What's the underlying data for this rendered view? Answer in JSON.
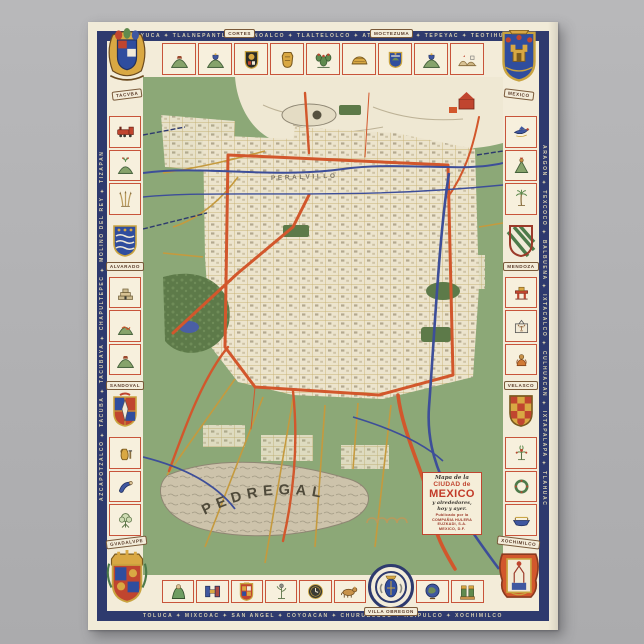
{
  "poster": {
    "kind": "vintage pictorial map poster of Mexico City on gray backdrop"
  },
  "colors": {
    "backdrop_gray": "#b3b3b5",
    "paper_cream": "#f1ebd8",
    "frame_blue": "#2e3a6e",
    "cell_border_red": "#c8543a",
    "map_green": "#8ca877",
    "water_blue": "#3d4e99",
    "road_orange": "#d2572c",
    "road_gold": "#c59a3e",
    "park_green": "#5d7a49",
    "pedregal_gray": "#cdc3ab",
    "accent_red": "#c0452f"
  },
  "banners": {
    "top_left_corner": "TACVBA",
    "top_right_corner": "MEXICO",
    "top_banner_1": "CORTES",
    "top_banner_2": "MOCTEZUMA",
    "left_shield_upper": "ALVARADO",
    "left_shield_lower": "SANDOVAL",
    "right_shield_upper": "MENDOZA",
    "right_shield_lower": "VELASCO",
    "bottom_left_corner": "GVADALVPE",
    "bottom_right_corner": "XOCHIMILCO",
    "bottom_medallion": "VILLA OBREGON"
  },
  "frame_text": {
    "top": "TENAYUCA ✦ TLALNEPANTLA ✦ NONOALCO ✦ TLALTELOLCO ✦ ATZACOALCO ✦ TEPEYAC ✦ TEOTIHUACAN",
    "bottom": "TOLUCA ✦ MIXCOAC ✦ SAN ANGEL ✦ COYOACAN ✦ CHURUBUSCO ✦ HUIPULCO ✦ XOCHIMILCO",
    "left": "AZCAPOTZALCO ✦ TACUBA ✦ TACUBAYA ✦ CHAPULTEPEC ✦ MOLINO DEL REY ✦ TIZAPAN",
    "right": "ARAGON ✦ TEXCOCO ✦ BALBUENA ✦ IXTACALCO ✦ CULHUACAN ✦ IXTAPALAPA ✦ TLAHUAC"
  },
  "map_labels": {
    "pedregal": "PEDREGAL",
    "peralvillo": "PERALVILLO"
  },
  "cartouche": {
    "line1": "Mapa de la",
    "line2": "CIUDAD de",
    "line3": "MEXICO",
    "line4": "y alrededores,",
    "line5": "hoy y ayer.",
    "small_lines": [
      "Publicado por la",
      "COMPAÑIA HULERA",
      "EUZKADI, S.A.",
      "MEXICO, D.F."
    ]
  },
  "border": {
    "top_cells": [
      "hill-cap",
      "hill-bell",
      "shield-cortes",
      "shield-gold",
      "cactus",
      "dome",
      "shield-blue",
      "hill-bell",
      "mountains"
    ],
    "bottom_left_cells": [
      "monk",
      "glyph-h",
      "shield-ornate",
      "bird-plant",
      "clock",
      "coyote"
    ],
    "bottom_right_cells": [
      "globe",
      "figures-two"
    ],
    "left_upper": [
      "train",
      "hill-plant",
      "reeds"
    ],
    "left_mid": [
      "pyramid",
      "hill-snake",
      "hill-cap"
    ],
    "left_lower": [
      "jug",
      "arm",
      "tree"
    ],
    "right_upper": [
      "bird-blue",
      "figure-green",
      "palm"
    ],
    "right_mid": [
      "altar",
      "deer-house",
      "figure-orange"
    ],
    "right_lower": [
      "flower",
      "wreath",
      "boat"
    ]
  }
}
